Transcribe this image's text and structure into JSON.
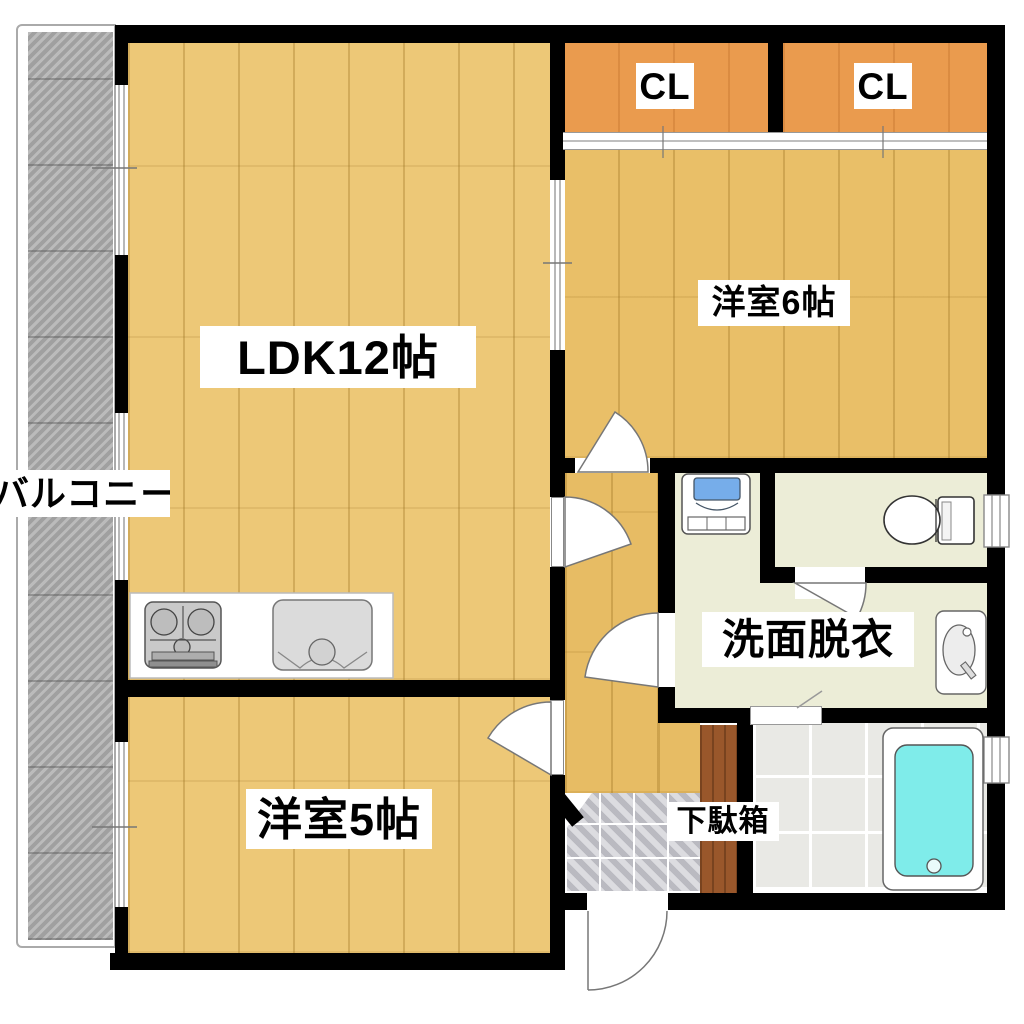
{
  "plan": {
    "type": "apartment-floor-plan",
    "rooms": {
      "ldk": "LDK12帖",
      "room6": "洋室6帖",
      "room5": "洋室5帖",
      "washroom": "洗面脱衣",
      "shoe_cabinet": "下駄箱",
      "closet_left": "CL",
      "closet_right": "CL",
      "balcony": "バルコニー"
    },
    "fixtures": [
      "gas-stove",
      "kitchen-sink",
      "washing-machine-pan",
      "toilet",
      "washbasin",
      "bathtub",
      "entrance-door",
      "shoe-cabinet"
    ]
  },
  "colors": {
    "wall": "#000000",
    "wood": "#EDC877",
    "wood6": "#E9BF68",
    "woodhall": "#E7BC64",
    "closet": "#EA9B4E",
    "cream": "#ECEDD7",
    "bathtile": "#E9E9E5",
    "genkantile": "#C9C9CF",
    "cabinet": "#99572B",
    "bathtub": "#7FECEA",
    "washer": "#76ADEA",
    "balcony": "#ACACAC"
  }
}
